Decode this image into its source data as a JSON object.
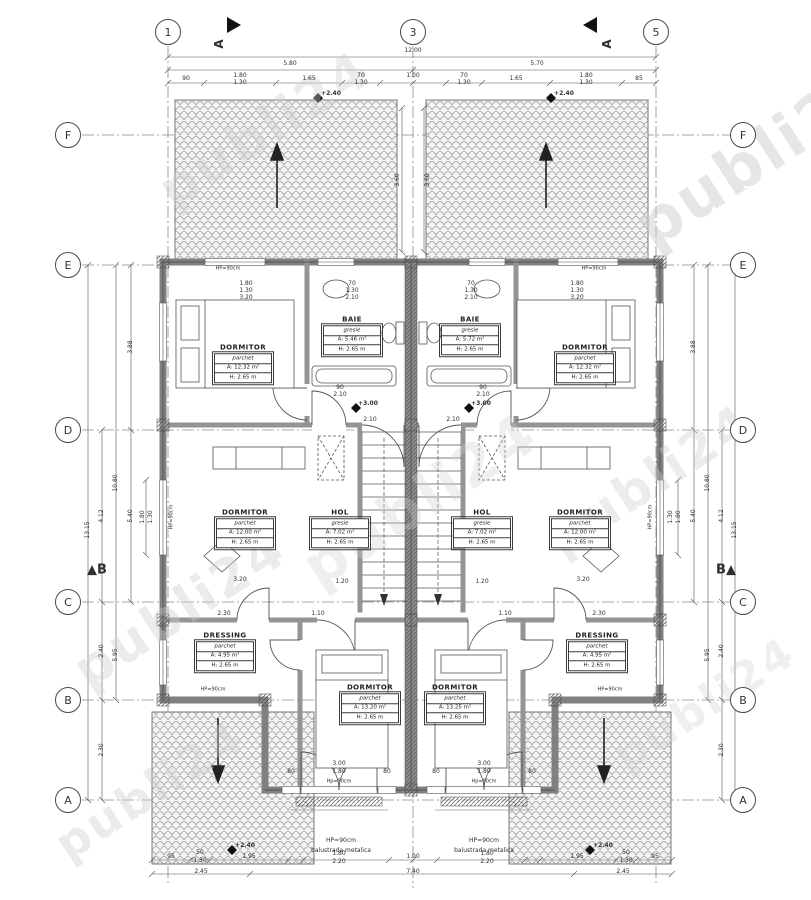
{
  "watermark_color": "#cfcfcf",
  "line_color": "#444444",
  "wall_color": "#808080",
  "grid_bubbles": [
    {
      "t": "1",
      "x": 168,
      "y": 32
    },
    {
      "t": "3",
      "x": 413,
      "y": 32
    },
    {
      "t": "5",
      "x": 656,
      "y": 32
    },
    {
      "t": "F",
      "x": 68,
      "y": 135
    },
    {
      "t": "E",
      "x": 68,
      "y": 265
    },
    {
      "t": "D",
      "x": 68,
      "y": 430
    },
    {
      "t": "C",
      "x": 68,
      "y": 602
    },
    {
      "t": "B",
      "x": 68,
      "y": 700
    },
    {
      "t": "A",
      "x": 68,
      "y": 800
    },
    {
      "t": "F",
      "x": 743,
      "y": 135
    },
    {
      "t": "E",
      "x": 743,
      "y": 265
    },
    {
      "t": "D",
      "x": 743,
      "y": 430
    },
    {
      "t": "C",
      "x": 743,
      "y": 602
    },
    {
      "t": "B",
      "x": 743,
      "y": 700
    },
    {
      "t": "A",
      "x": 743,
      "y": 800
    }
  ],
  "rooms": [
    {
      "name": "DORMITOR",
      "material": "parchet",
      "area": "A: 12.32 m²",
      "height": "H: 2.65 m",
      "x": 243,
      "y": 363
    },
    {
      "name": "BAIE",
      "material": "gresie",
      "area": "A: 5.46 m²",
      "height": "H: 2.65 m",
      "x": 352,
      "y": 335
    },
    {
      "name": "DORMITOR",
      "material": "parchet",
      "area": "A: 12.00 m²",
      "height": "H: 2.65 m",
      "x": 245,
      "y": 528
    },
    {
      "name": "HOL",
      "material": "gresie",
      "area": "A: 7.02 m²",
      "height": "H: 2.65 m",
      "x": 340,
      "y": 528
    },
    {
      "name": "DRESSING",
      "material": "parchet",
      "area": "A: 4.95 m²",
      "height": "H: 2.65 m",
      "x": 225,
      "y": 651
    },
    {
      "name": "DORMITOR",
      "material": "parchet",
      "area": "A: 13.20 m²",
      "height": "H: 2.65 m",
      "x": 370,
      "y": 703
    },
    {
      "name": "DORMITOR",
      "material": "parchet",
      "area": "A: 12.32 m²",
      "height": "H: 2.65 m",
      "x": 585,
      "y": 363
    },
    {
      "name": "BAIE",
      "material": "gresie",
      "area": "A: 5.72 m²",
      "height": "H: 2.65 m",
      "x": 470,
      "y": 335
    },
    {
      "name": "DORMITOR",
      "material": "parchet",
      "area": "A: 12.00 m²",
      "height": "H: 2.65 m",
      "x": 580,
      "y": 528
    },
    {
      "name": "HOL",
      "material": "gresie",
      "area": "A: 7.02 m²",
      "height": "H: 2.65 m",
      "x": 482,
      "y": 528
    },
    {
      "name": "DRESSING",
      "material": "parchet",
      "area": "A: 4.95 m²",
      "height": "H: 2.65 m",
      "x": 597,
      "y": 651
    },
    {
      "name": "DORMITOR",
      "material": "parchet",
      "area": "A: 13.25 m²",
      "height": "H: 2.65 m",
      "x": 455,
      "y": 703
    }
  ],
  "labels": [
    {
      "t": "12.00",
      "x": 413,
      "y": 51
    },
    {
      "t": "5.80",
      "x": 290,
      "y": 64
    },
    {
      "t": "5.70",
      "x": 537,
      "y": 64
    },
    {
      "t": "90",
      "x": 186,
      "y": 79
    },
    {
      "t": "1.80",
      "x": 240,
      "y": 76
    },
    {
      "t": "1.30",
      "x": 240,
      "y": 83
    },
    {
      "t": "1.65",
      "x": 309,
      "y": 79
    },
    {
      "t": "70",
      "x": 361,
      "y": 76
    },
    {
      "t": "1.30",
      "x": 361,
      "y": 83
    },
    {
      "t": "1.00",
      "x": 413,
      "y": 76
    },
    {
      "t": "70",
      "x": 464,
      "y": 76
    },
    {
      "t": "1.30",
      "x": 464,
      "y": 83
    },
    {
      "t": "1.65",
      "x": 516,
      "y": 79
    },
    {
      "t": "1.80",
      "x": 586,
      "y": 76
    },
    {
      "t": "1.30",
      "x": 586,
      "y": 83
    },
    {
      "t": "85",
      "x": 639,
      "y": 79
    },
    {
      "t": "3.60",
      "x": 398,
      "y": 180,
      "r": -90
    },
    {
      "t": "3.60",
      "x": 428,
      "y": 180,
      "r": -90
    },
    {
      "t": "1.80",
      "x": 246,
      "y": 284
    },
    {
      "t": "1.30",
      "x": 246,
      "y": 291
    },
    {
      "t": "3.20",
      "x": 246,
      "y": 298
    },
    {
      "t": "70",
      "x": 352,
      "y": 284
    },
    {
      "t": "1.30",
      "x": 352,
      "y": 291
    },
    {
      "t": "2.10",
      "x": 352,
      "y": 298
    },
    {
      "t": "1.80",
      "x": 577,
      "y": 284
    },
    {
      "t": "1.30",
      "x": 577,
      "y": 291
    },
    {
      "t": "3.20",
      "x": 577,
      "y": 298
    },
    {
      "t": "70",
      "x": 471,
      "y": 284
    },
    {
      "t": "1.30",
      "x": 471,
      "y": 291
    },
    {
      "t": "2.10",
      "x": 471,
      "y": 298
    },
    {
      "t": "90",
      "x": 340,
      "y": 388
    },
    {
      "t": "2.10",
      "x": 340,
      "y": 395
    },
    {
      "t": "90",
      "x": 483,
      "y": 388
    },
    {
      "t": "2.10",
      "x": 483,
      "y": 395
    },
    {
      "t": "2.10",
      "x": 370,
      "y": 420
    },
    {
      "t": "2.10",
      "x": 453,
      "y": 420
    },
    {
      "t": "+3.00",
      "x": 368,
      "y": 404,
      "s": 6,
      "w": "700"
    },
    {
      "t": "+3.00",
      "x": 481,
      "y": 404,
      "s": 6,
      "w": "700"
    },
    {
      "t": "+2.40",
      "x": 331,
      "y": 94,
      "s": 6,
      "w": "700"
    },
    {
      "t": "+2.40",
      "x": 564,
      "y": 94,
      "s": 6,
      "w": "700"
    },
    {
      "t": "+2.40",
      "x": 245,
      "y": 846,
      "s": 6,
      "w": "700"
    },
    {
      "t": "+2.40",
      "x": 603,
      "y": 846,
      "s": 6,
      "w": "700"
    },
    {
      "t": "1.20",
      "x": 342,
      "y": 582
    },
    {
      "t": "1.20",
      "x": 482,
      "y": 582
    },
    {
      "t": "3.20",
      "x": 240,
      "y": 580
    },
    {
      "t": "3.20",
      "x": 583,
      "y": 580
    },
    {
      "t": "2.30",
      "x": 224,
      "y": 614
    },
    {
      "t": "1.10",
      "x": 318,
      "y": 614
    },
    {
      "t": "1.10",
      "x": 505,
      "y": 614
    },
    {
      "t": "2.30",
      "x": 599,
      "y": 614
    },
    {
      "t": "3.00",
      "x": 339,
      "y": 764
    },
    {
      "t": "1.80",
      "x": 339,
      "y": 772
    },
    {
      "t": "3.00",
      "x": 484,
      "y": 764
    },
    {
      "t": "1.80",
      "x": 484,
      "y": 772
    },
    {
      "t": "80",
      "x": 291,
      "y": 772
    },
    {
      "t": "80",
      "x": 387,
      "y": 772
    },
    {
      "t": "80",
      "x": 436,
      "y": 772
    },
    {
      "t": "80",
      "x": 532,
      "y": 772
    },
    {
      "t": "3.88",
      "x": 131,
      "y": 347,
      "r": -90
    },
    {
      "t": "5.40",
      "x": 131,
      "y": 516,
      "r": -90
    },
    {
      "t": "13.15",
      "x": 88,
      "y": 530,
      "r": -90
    },
    {
      "t": "4.12",
      "x": 102,
      "y": 516,
      "r": -90
    },
    {
      "t": "2.40",
      "x": 102,
      "y": 651,
      "r": -90
    },
    {
      "t": "2.30",
      "x": 102,
      "y": 750,
      "r": -90
    },
    {
      "t": "10.80",
      "x": 116,
      "y": 483,
      "r": -90
    },
    {
      "t": "5.95",
      "x": 116,
      "y": 655,
      "r": -90
    },
    {
      "t": "1.80",
      "x": 143,
      "y": 517,
      "r": -90
    },
    {
      "t": "1.30",
      "x": 151,
      "y": 517,
      "r": -90
    },
    {
      "t": "3.88",
      "x": 694,
      "y": 347,
      "r": -90
    },
    {
      "t": "5.40",
      "x": 694,
      "y": 516,
      "r": -90
    },
    {
      "t": "13.15",
      "x": 735,
      "y": 530,
      "r": -90
    },
    {
      "t": "4.12",
      "x": 722,
      "y": 516,
      "r": -90
    },
    {
      "t": "2.40",
      "x": 722,
      "y": 651,
      "r": -90
    },
    {
      "t": "2.30",
      "x": 722,
      "y": 750,
      "r": -90
    },
    {
      "t": "10.80",
      "x": 708,
      "y": 483,
      "r": -90
    },
    {
      "t": "5.95",
      "x": 708,
      "y": 655,
      "r": -90
    },
    {
      "t": "1.80",
      "x": 679,
      "y": 517,
      "r": -90
    },
    {
      "t": "1.30",
      "x": 671,
      "y": 517,
      "r": -90
    },
    {
      "t": "95",
      "x": 171,
      "y": 857
    },
    {
      "t": "50",
      "x": 200,
      "y": 853
    },
    {
      "t": "1.30",
      "x": 200,
      "y": 861
    },
    {
      "t": "1.95",
      "x": 249,
      "y": 857
    },
    {
      "t": "1.80",
      "x": 339,
      "y": 854
    },
    {
      "t": "2.20",
      "x": 339,
      "y": 862
    },
    {
      "t": "1.00",
      "x": 413,
      "y": 857
    },
    {
      "t": "1.80",
      "x": 487,
      "y": 854
    },
    {
      "t": "2.20",
      "x": 487,
      "y": 862
    },
    {
      "t": "1.95",
      "x": 577,
      "y": 857
    },
    {
      "t": "50",
      "x": 626,
      "y": 853
    },
    {
      "t": "1.30",
      "x": 626,
      "y": 861
    },
    {
      "t": "95",
      "x": 655,
      "y": 857
    },
    {
      "t": "2.45",
      "x": 201,
      "y": 872
    },
    {
      "t": "7.40",
      "x": 413,
      "y": 872
    },
    {
      "t": "2.45",
      "x": 623,
      "y": 872
    },
    {
      "t": "HP=90cm",
      "x": 228,
      "y": 269,
      "s": 5
    },
    {
      "t": "HP=90cm",
      "x": 594,
      "y": 269,
      "s": 5
    },
    {
      "t": "HP=90cm",
      "x": 172,
      "y": 517,
      "r": -90,
      "s": 5
    },
    {
      "t": "HP=90cm",
      "x": 651,
      "y": 517,
      "r": -90,
      "s": 5
    },
    {
      "t": "HP=90cm",
      "x": 213,
      "y": 690,
      "s": 5
    },
    {
      "t": "HP=90cm",
      "x": 610,
      "y": 690,
      "s": 5
    },
    {
      "t": "Hp=90cm",
      "x": 339,
      "y": 782,
      "s": 5
    },
    {
      "t": "Hp=90cm",
      "x": 484,
      "y": 782,
      "s": 5
    },
    {
      "t": "HP=90cm",
      "x": 341,
      "y": 841,
      "s": 6
    },
    {
      "t": "balustrada metalica",
      "x": 341,
      "y": 851,
      "s": 6
    },
    {
      "t": "HP=90cm",
      "x": 484,
      "y": 841,
      "s": 6
    },
    {
      "t": "balustrada metalica",
      "x": 484,
      "y": 851,
      "s": 6
    },
    {
      "t": "A",
      "x": 219,
      "y": 44,
      "r": -90,
      "s": 12,
      "w": "700"
    },
    {
      "t": "A",
      "x": 607,
      "y": 44,
      "r": -90,
      "s": 12,
      "w": "700"
    },
    {
      "t": "▲B",
      "x": 97,
      "y": 570,
      "s": 13,
      "w": "700"
    },
    {
      "t": "B▲",
      "x": 726,
      "y": 570,
      "s": 13,
      "w": "700"
    }
  ],
  "watermarks": [
    {
      "t": "publi24",
      "x": 265,
      "y": 130,
      "s": 52,
      "r": -33,
      "o": 0.38
    },
    {
      "t": "publi24",
      "x": 760,
      "y": 155,
      "s": 62,
      "r": -33,
      "o": 0.5
    },
    {
      "t": "publi24",
      "x": 180,
      "y": 610,
      "s": 52,
      "r": -33,
      "o": 0.4
    },
    {
      "t": "publi24",
      "x": 420,
      "y": 500,
      "s": 58,
      "r": -33,
      "o": 0.32
    },
    {
      "t": "publi24",
      "x": 650,
      "y": 480,
      "s": 50,
      "r": -33,
      "o": 0.38
    },
    {
      "t": "publi24",
      "x": 150,
      "y": 790,
      "s": 46,
      "r": -33,
      "o": 0.4
    },
    {
      "t": "publi24",
      "x": 705,
      "y": 705,
      "s": 44,
      "r": -33,
      "o": 0.32
    }
  ]
}
